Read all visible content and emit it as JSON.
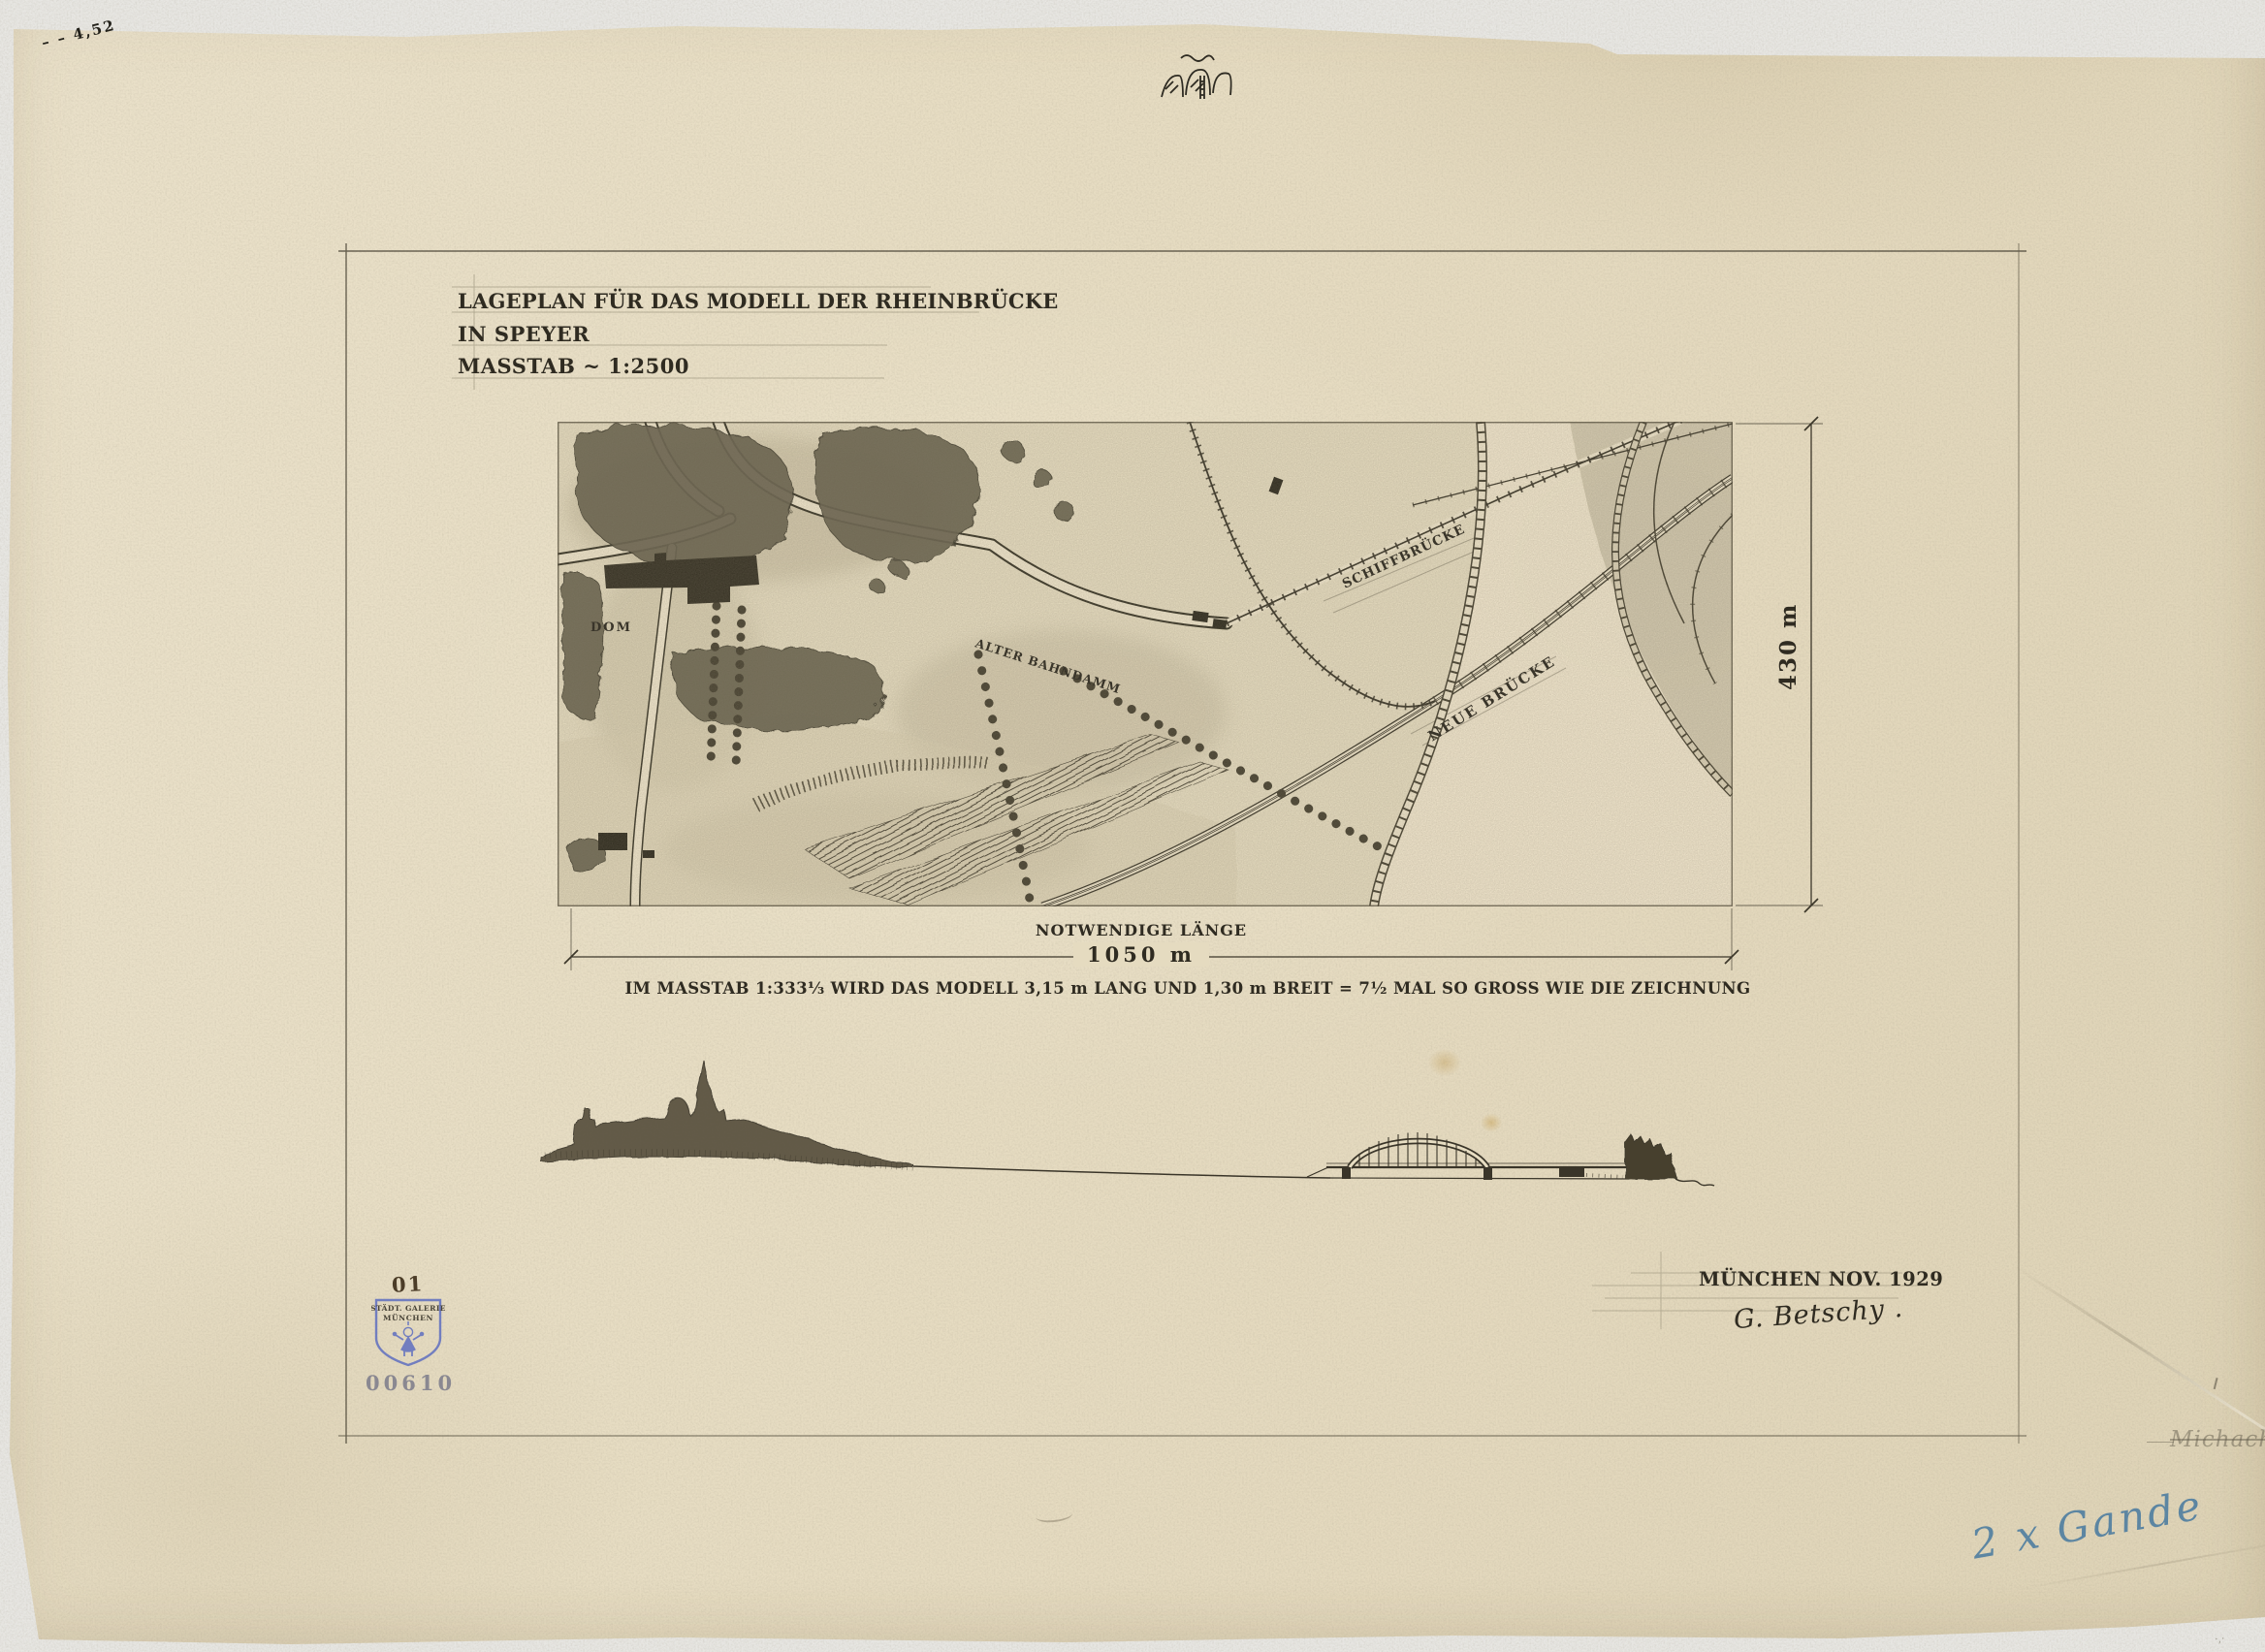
{
  "title_block": {
    "line1": "LAGEPLAN FÜR DAS MODELL DER RHEINBRÜCKE",
    "line2": "IN SPEYER",
    "line3": "MASSTAB ~ 1:2500"
  },
  "map": {
    "labels": {
      "dom": "DOM",
      "alter_bahndamm": "ALTER BAHNDAMM",
      "schiffbruecke": "SCHIFFBRÜCKE",
      "neue_bruecke": "NEUE BRÜCKE"
    }
  },
  "dimensions": {
    "height": "430 m",
    "length_label": "NOTWENDIGE LÄNGE",
    "length_value": "1050 m"
  },
  "scale_note": "IM MASSTAB 1:333⅓ WIRD DAS MODELL  3,15 m LANG  UND 1,30 m BREIT   =  7½ MAL SO GROSS WIE DIE ZEICHNUNG",
  "footer": {
    "place_date": "MÜNCHEN NOV. 1929",
    "signature": "G. Betschy ."
  },
  "stamps": {
    "handwritten_number": "01",
    "gallery_line1": "STÄDT. GALERIE",
    "gallery_line2": "MÜNCHEN",
    "accession_number": "00610"
  },
  "annotations": {
    "blue_note": "2 x Gande",
    "top_left_mark": "– – 4,52",
    "edge_note": "Michach"
  },
  "colors": {
    "paper": "#e7ddc3",
    "ink": "#2f2b21",
    "pencil": "#8f8871",
    "stamp_blue": "#5f6fc0",
    "accession_gray": "#8a8891",
    "note_blue": "#47799f",
    "sepia": "#4c3d28"
  }
}
